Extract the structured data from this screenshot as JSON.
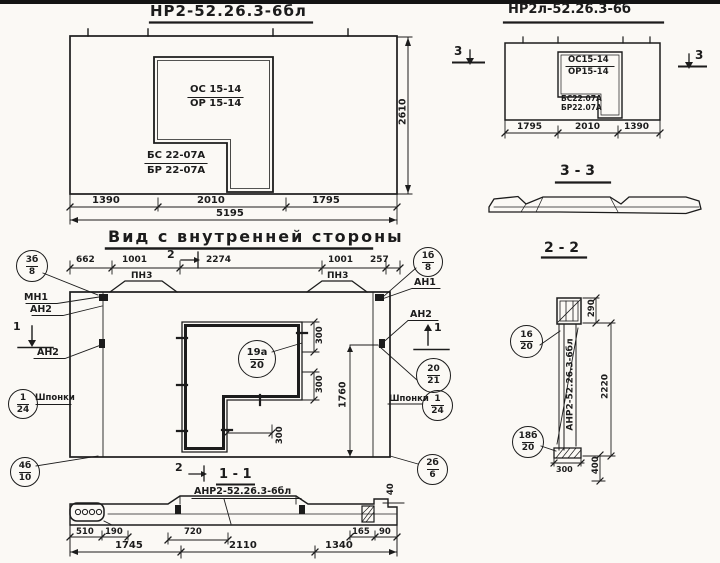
{
  "drawing": {
    "outer_view": {
      "title": "НР2-52.26.3-6бл",
      "opening": {
        "line1": "ОС 15-14",
        "line2": "ОР 15-14",
        "line3": "БС 22-07А",
        "line4": "БР 22-07А"
      },
      "dim_height": "2610",
      "dim_segments": [
        "1390",
        "2010",
        "1795"
      ],
      "dim_total": "5195"
    },
    "mirror_view": {
      "title": "НР2л-52.26.3-6б",
      "opening": {
        "line1": "ОС15-14",
        "line2": "ОР15-14",
        "line3": "БС22.07А",
        "line4": "БР22.07А"
      },
      "dim_segments": [
        "1795",
        "2010",
        "1390"
      ],
      "section_mark": "3"
    },
    "section_33": {
      "title": "3 - 3"
    },
    "section_22": {
      "title": "2 - 2",
      "stamp": "АНР2-52.26.3-6бл",
      "dim_top": "290",
      "dim_height": "2220",
      "dim_bottom_w": "300",
      "dim_bottom_h": "400",
      "callout_upper": {
        "num": "16",
        "den": "20"
      },
      "callout_lower": {
        "num": "18б",
        "den": "20"
      }
    },
    "inner_view": {
      "title": "Вид с внутренней стороны",
      "dim_top": [
        "662",
        "1001",
        "2274",
        "1001",
        "257"
      ],
      "loop_label": "ПН3",
      "label_mn1": "МН1",
      "label_an2": "АН2",
      "label_an1": "АН1",
      "label_keys": "Шпонки",
      "mark_1": "1",
      "mark_2": "2",
      "dim_300": "300",
      "dim_height": "1760",
      "callout_opening": {
        "num": "19а",
        "den": "20"
      },
      "callout_tl": {
        "num": "3б",
        "den": "8"
      },
      "callout_keys_left": {
        "num": "1",
        "den": "24"
      },
      "callout_bl": {
        "num": "4б",
        "den": "10"
      },
      "callout_tr": {
        "num": "1б",
        "den": "8"
      },
      "callout_r1": {
        "num": "20",
        "den": "21"
      },
      "callout_keys_right": {
        "num": "1",
        "den": "24"
      },
      "callout_br": {
        "num": "2б",
        "den": "6"
      }
    },
    "section_11": {
      "title": "1 - 1",
      "stamp": "АНР2-52.26.3-6бл",
      "dim_upper": [
        "510",
        "190",
        "720",
        "165",
        "90"
      ],
      "dim_lower": [
        "1745",
        "2110",
        "1340"
      ],
      "dim_40": "40"
    }
  }
}
